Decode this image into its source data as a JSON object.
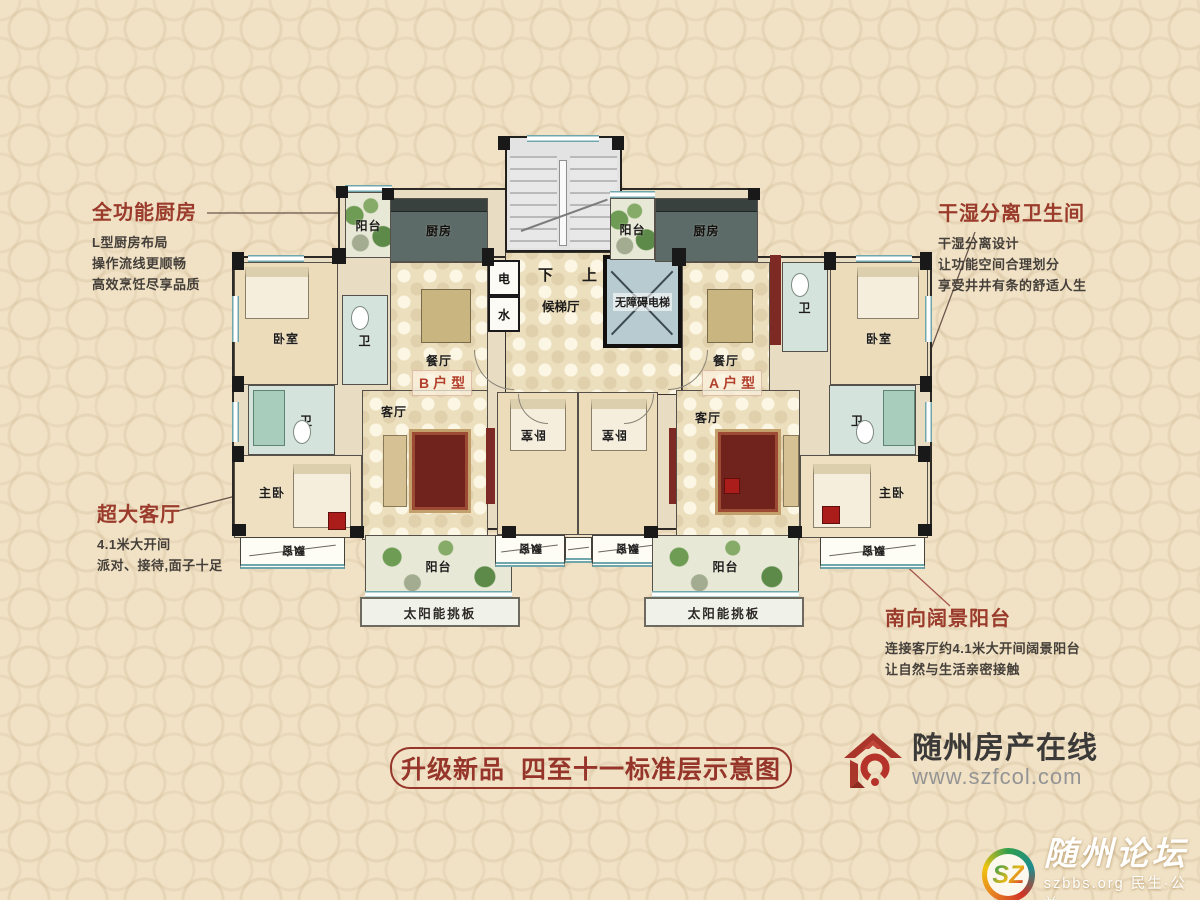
{
  "annotations": {
    "kitchen": {
      "title": "全功能厨房",
      "lines": [
        "L型厨房布局",
        "操作流线更顺畅",
        "高效烹饪尽享品质"
      ]
    },
    "bathroom": {
      "title": "干湿分离卫生间",
      "lines": [
        "干湿分离设计",
        "让功能空间合理划分",
        "享受井井有条的舒适人生"
      ]
    },
    "living": {
      "title": "超大客厅",
      "lines": [
        "4.1米大开间",
        "派对、接待,面子十足"
      ]
    },
    "balcony": {
      "title": "南向阔景阳台",
      "lines": [
        "连接客厅约4.1米大开间阔景阳台",
        "让自然与生活亲密接触"
      ]
    }
  },
  "rooms": {
    "balcony": "阳台",
    "kitchen": "厨房",
    "dining": "餐厅",
    "bedroom": "卧室",
    "bath": "卫",
    "living": "客厅",
    "master": "主卧",
    "bay_window": "飘窗",
    "solar_board": "太阳能挑板",
    "elevator_hall": "候梯厅",
    "elevator": "无障碍电梯",
    "shaft_power": "电",
    "shaft_water": "水",
    "stairs_down": "下",
    "stairs_up": "上",
    "unit_b": "B户型",
    "unit_a": "A户型"
  },
  "banner": {
    "text": "升级新品  四至十一标准层示意图"
  },
  "brand": {
    "name": "随州房产在线",
    "website": "www.szfcol.com"
  },
  "watermark": {
    "monogram": "SZ",
    "name": "随州论坛",
    "tagline": "szbbs.org 民生·公益"
  },
  "colors": {
    "accent_red": "#96352a",
    "wall": "#191919",
    "kitchen_floor": "#5c6b68",
    "bath_floor": "#d4e3dc"
  }
}
